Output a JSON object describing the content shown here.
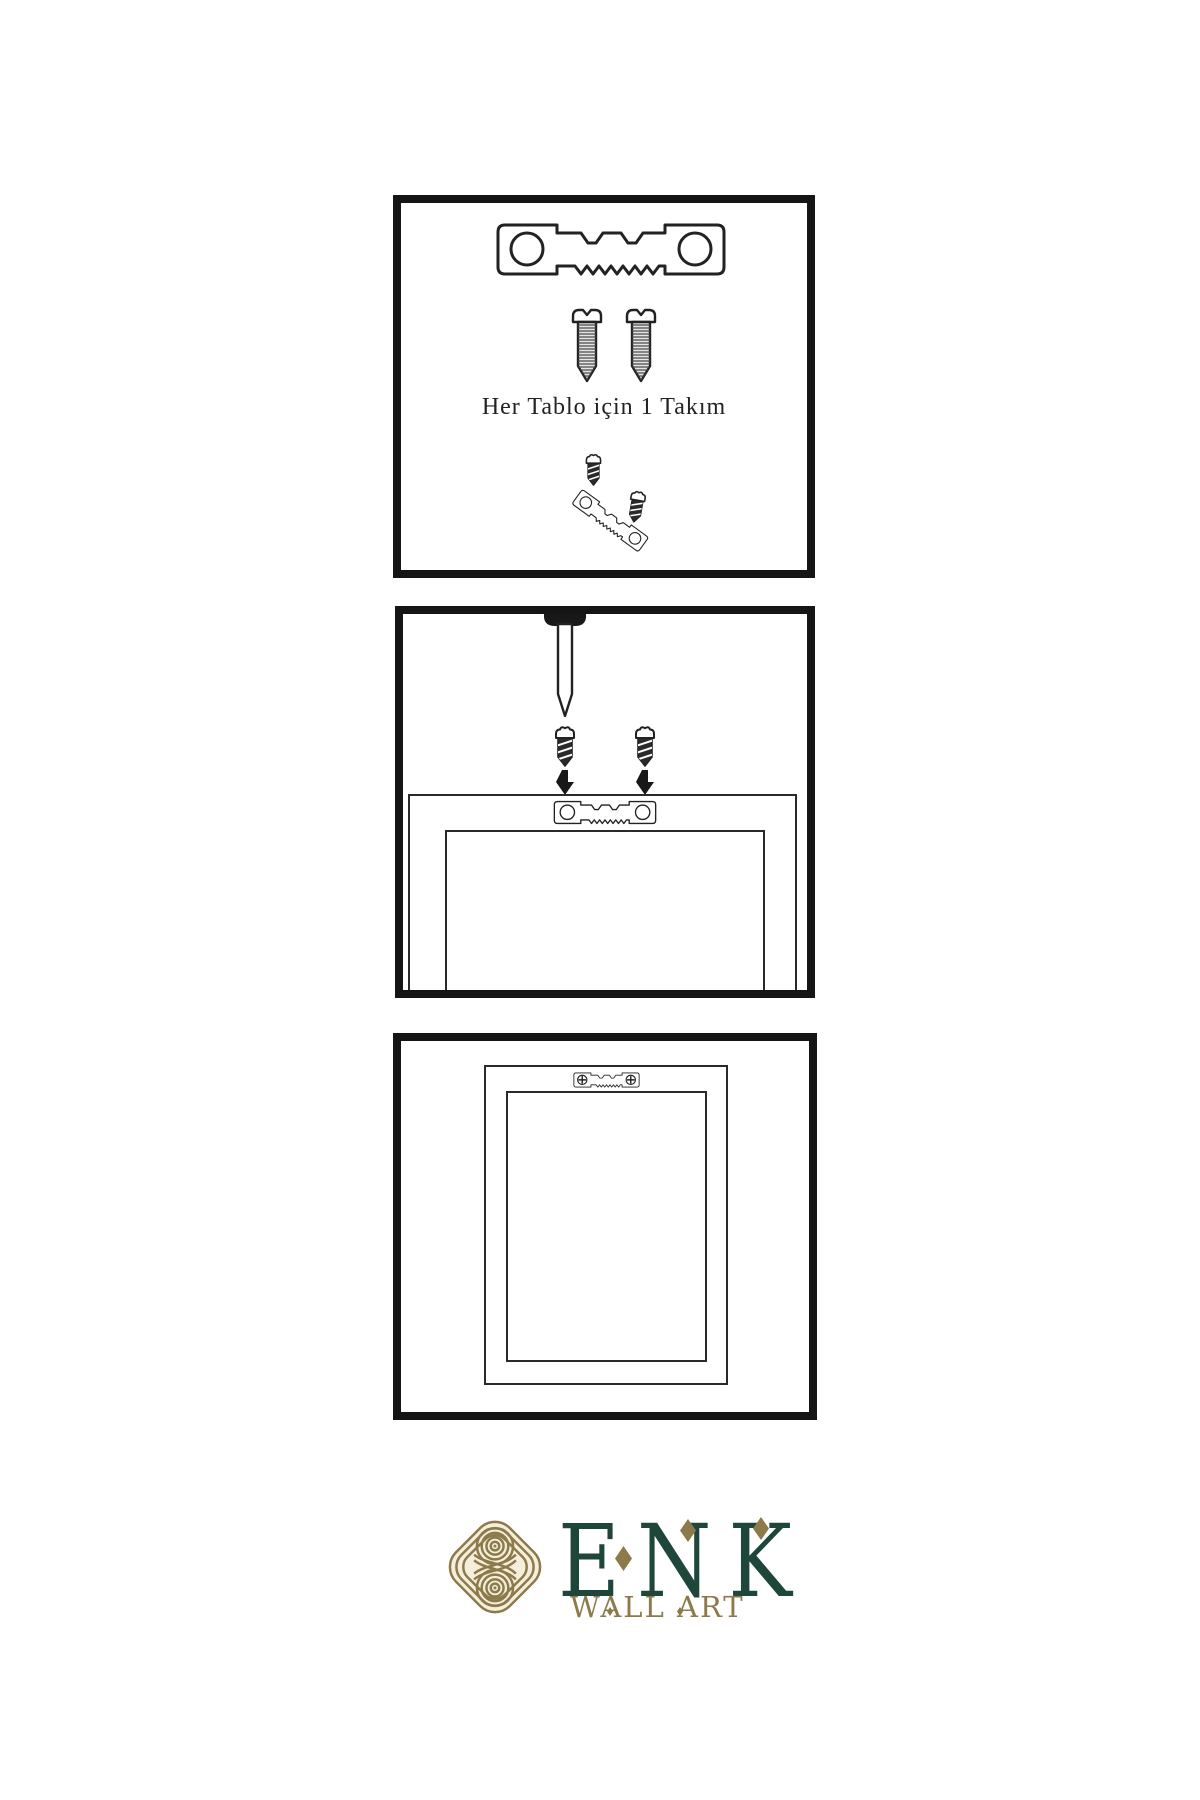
{
  "step1": {
    "caption": "Her Tablo için 1 Takım"
  },
  "brand": {
    "name": "ENK",
    "subtitle": "WALL ART"
  },
  "colors": {
    "background": "#ffffff",
    "ink": "#222222",
    "border": "#151515",
    "gold": "#8d7a4b",
    "green": "#1e463a",
    "cream": "#f5eedb"
  },
  "icons": {
    "sawtooth_hanger": "sawtooth-hanger-icon",
    "sawtooth_hanger_screwed": "sawtooth-hanger-screwed-icon",
    "screw_light": "screw-icon",
    "screw_dark": "screw-icon",
    "nail": "nail-icon",
    "arrow_down": "arrow-down-icon",
    "brand_knot": "interlaced-knot-icon"
  }
}
